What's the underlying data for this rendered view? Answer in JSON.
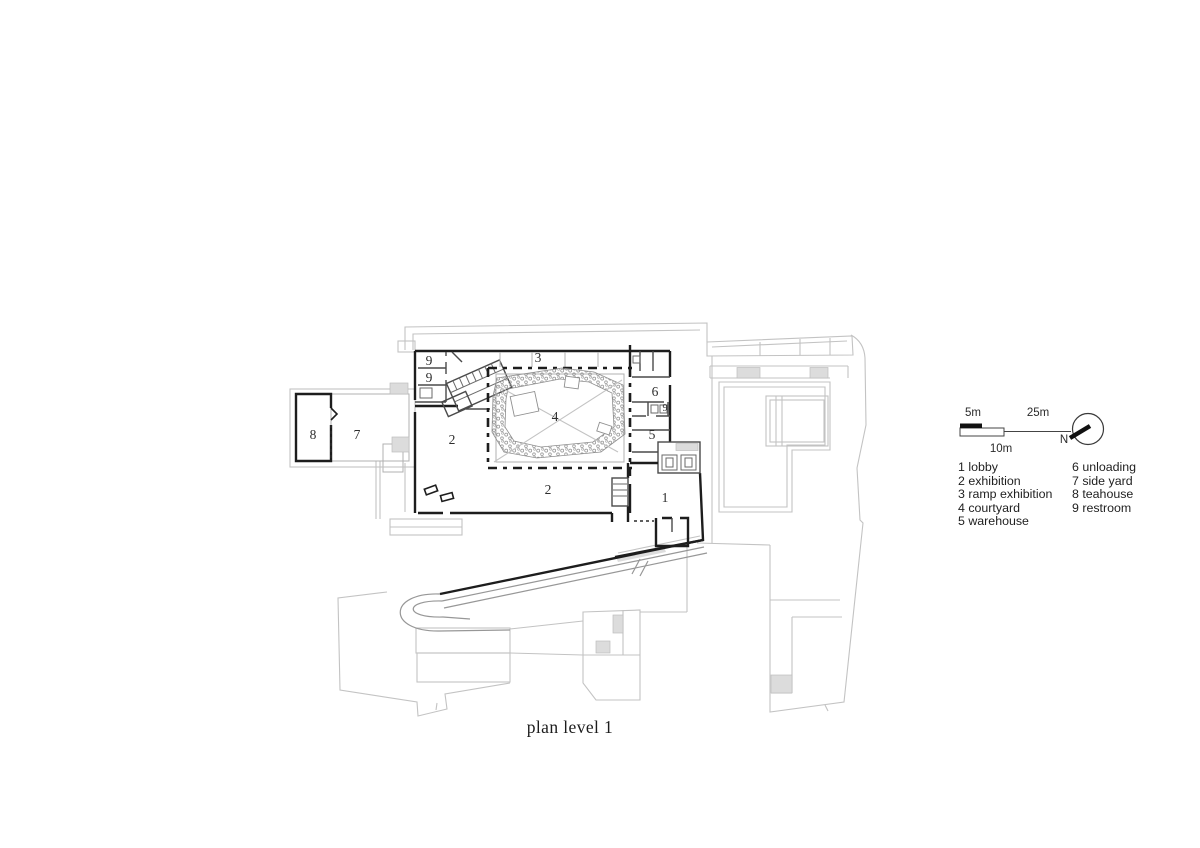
{
  "caption": "plan level 1",
  "colors": {
    "wall": "#1d1d1d",
    "partition": "#4a4a4a",
    "context": "#c3c3c3",
    "ramp": "#979797",
    "hatch_fill": "#dcdcdc",
    "background": "#ffffff",
    "text": "#2d2d2d"
  },
  "plan": {
    "room_labels": [
      {
        "n": "9",
        "name": "restroom"
      },
      {
        "n": "9",
        "name": "restroom"
      },
      {
        "n": "3",
        "name": "ramp exhibition"
      },
      {
        "n": "4",
        "name": "courtyard"
      },
      {
        "n": "2",
        "name": "exhibition west"
      },
      {
        "n": "2",
        "name": "exhibition south"
      },
      {
        "n": "6",
        "name": "unloading"
      },
      {
        "n": "9",
        "name": "restroom small"
      },
      {
        "n": "5",
        "name": "warehouse"
      },
      {
        "n": "1",
        "name": "lobby"
      },
      {
        "n": "8",
        "name": "teahouse"
      },
      {
        "n": "7",
        "name": "side yard"
      }
    ]
  },
  "scalebar": {
    "five": "5m",
    "ten": "10m",
    "twentyfive": "25m",
    "north": "N"
  },
  "legend": {
    "columns": [
      [
        "1 lobby",
        "2 exhibition",
        "3 ramp exhibition",
        "4 courtyard",
        "5 warehouse"
      ],
      [
        "6 unloading",
        "7 side yard",
        "8 teahouse",
        "9 restroom"
      ]
    ]
  }
}
